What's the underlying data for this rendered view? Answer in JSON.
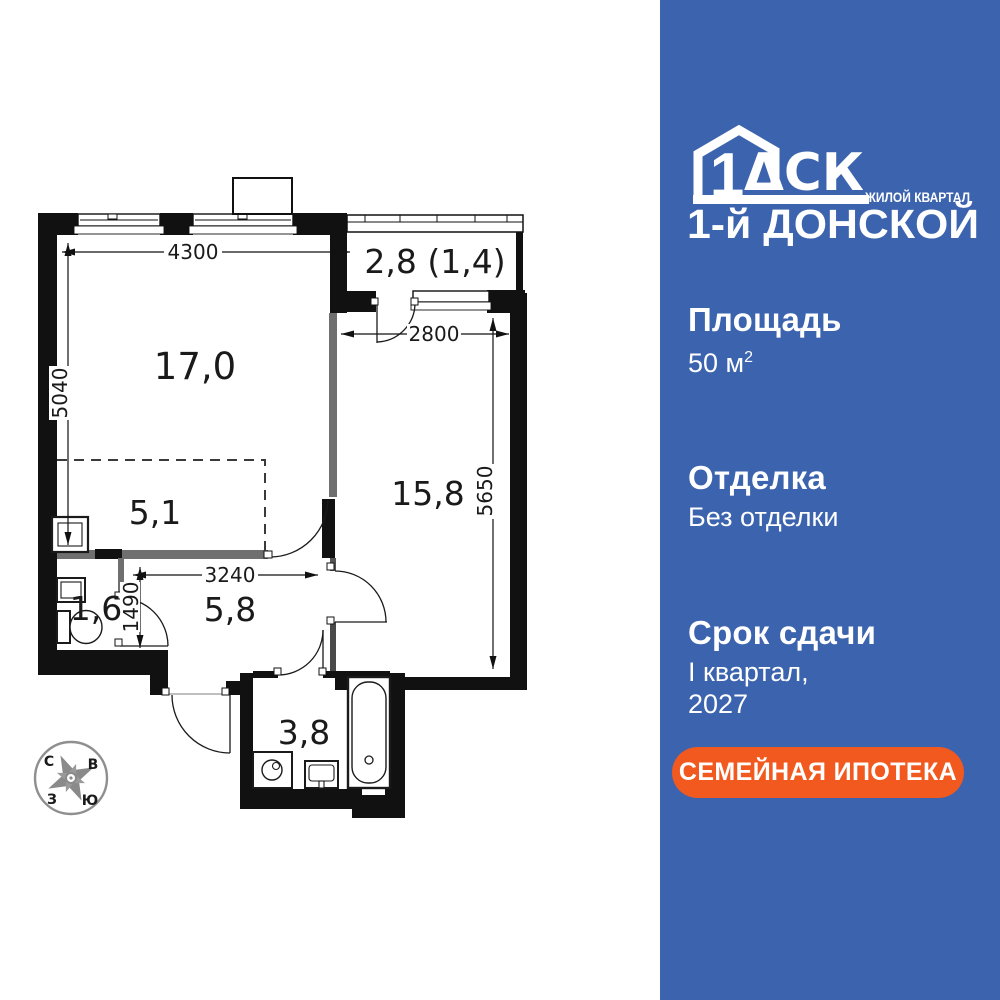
{
  "colors": {
    "sidebar_bg": "#3B63AE",
    "cta_bg": "#F1591F",
    "wall": "#111111",
    "partition": "#6F6F6F"
  },
  "sidebar": {
    "logo": {
      "number": "1",
      "letters": "ΔСК",
      "tagline": "ЖИЛОЙ КВАРТАЛ",
      "project": "1-й ДОНСКОЙ"
    },
    "specs": {
      "area_label": "Площадь",
      "area_value": "50 м",
      "area_sup": "2",
      "finish_label": "Отделка",
      "finish_value": "Без отделки",
      "deadline_label": "Срок сдачи",
      "deadline_line1": "I квартал,",
      "deadline_line2": "2027"
    },
    "cta_label": "СЕМЕЙНАЯ ИПОТЕКА"
  },
  "floorplan": {
    "rooms": {
      "living": "17,0",
      "kitchen_zone": "5,1",
      "balcony": "2,8 (1,4)",
      "bedroom": "15,8",
      "hall": "5,8",
      "wc": "1,6",
      "bath": "3,8"
    },
    "dims": {
      "top_width": "4300",
      "left_height": "5040",
      "bedroom_width": "2800",
      "bedroom_height": "5650",
      "hall_width": "3240",
      "hall_height": "1490"
    },
    "compass": {
      "north": "С",
      "east": "В",
      "west": "З",
      "south": "Ю"
    }
  }
}
